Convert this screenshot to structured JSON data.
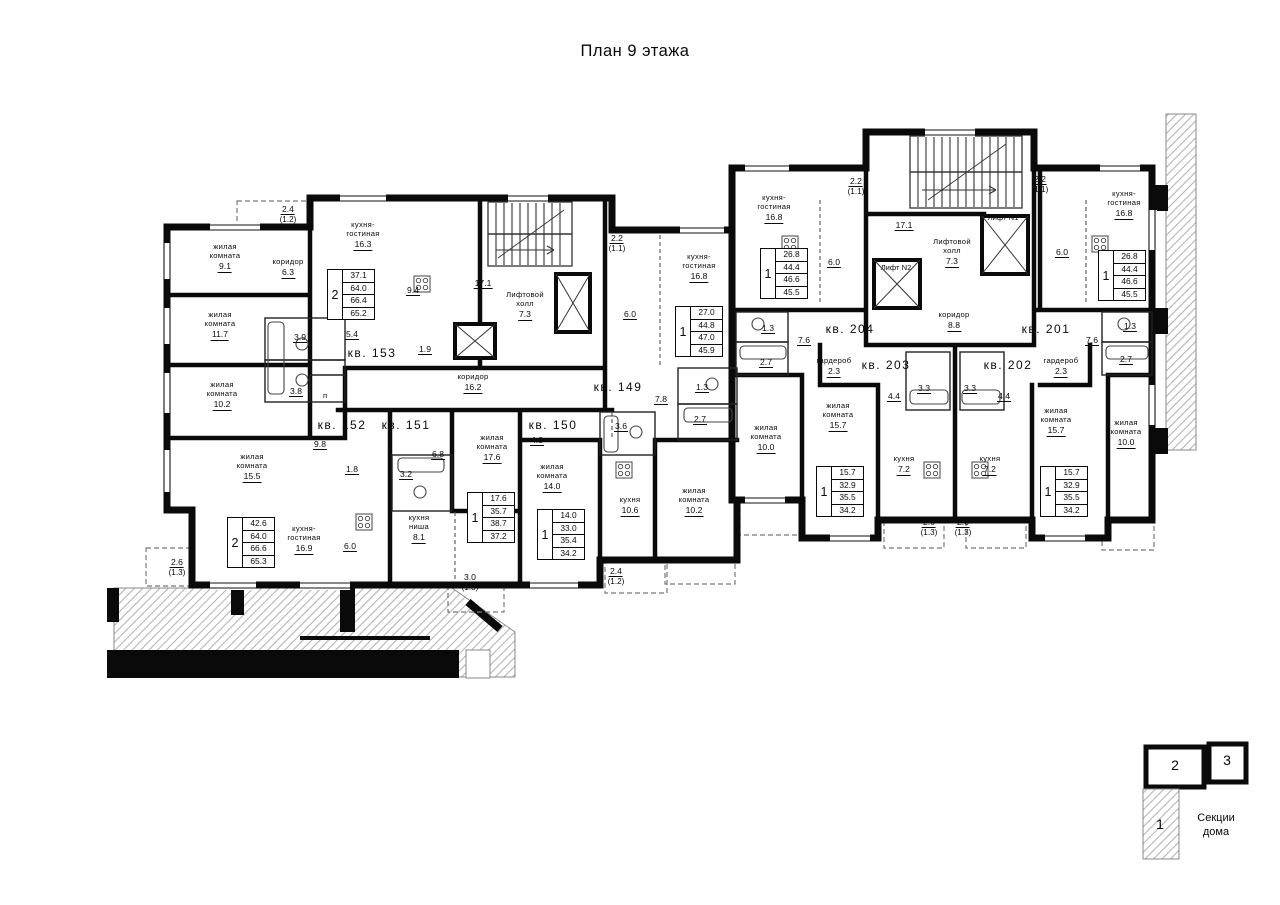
{
  "title": {
    "text": "План 9 этажа"
  },
  "colors": {
    "ink": "#0a0a0a",
    "hatch": "#b5b5b5",
    "balcony_dash": "#777777"
  },
  "legend": {
    "caption_lines": [
      "Секции",
      "дома"
    ],
    "sections": [
      "1",
      "2",
      "3"
    ]
  },
  "spec_tables": [
    {
      "x": 327,
      "y": 269,
      "rooms": "2",
      "values": [
        "37.1",
        "64.0",
        "66.4",
        "65.2"
      ]
    },
    {
      "x": 227,
      "y": 517,
      "rooms": "2",
      "values": [
        "42.6",
        "64.0",
        "66.6",
        "65.3"
      ]
    },
    {
      "x": 467,
      "y": 492,
      "rooms": "1",
      "values": [
        "17.6",
        "35.7",
        "38.7",
        "37.2"
      ]
    },
    {
      "x": 537,
      "y": 509,
      "rooms": "1",
      "values": [
        "14.0",
        "33.0",
        "35.4",
        "34.2"
      ]
    },
    {
      "x": 675,
      "y": 306,
      "rooms": "1",
      "values": [
        "27.0",
        "44.8",
        "47.0",
        "45.9"
      ]
    },
    {
      "x": 760,
      "y": 248,
      "rooms": "1",
      "values": [
        "26.8",
        "44.4",
        "46.6",
        "45.5"
      ]
    },
    {
      "x": 816,
      "y": 466,
      "rooms": "1",
      "values": [
        "15.7",
        "32.9",
        "35.5",
        "34.2"
      ]
    },
    {
      "x": 1040,
      "y": 466,
      "rooms": "1",
      "values": [
        "15.7",
        "32.9",
        "35.5",
        "34.2"
      ]
    },
    {
      "x": 1098,
      "y": 250,
      "rooms": "1",
      "values": [
        "26.8",
        "44.4",
        "46.6",
        "45.5"
      ]
    }
  ],
  "labels": [
    {
      "x": 225,
      "y": 243,
      "kind": "room",
      "lines": [
        "жилая",
        "комната"
      ],
      "area": "9.1"
    },
    {
      "x": 288,
      "y": 258,
      "kind": "room",
      "lines": [
        "коридор"
      ],
      "area": "6.3"
    },
    {
      "x": 363,
      "y": 221,
      "kind": "room",
      "lines": [
        "кухня-",
        "гостиная"
      ],
      "area": "16.3"
    },
    {
      "x": 413,
      "y": 284,
      "kind": "num",
      "area": "9.4"
    },
    {
      "x": 220,
      "y": 311,
      "kind": "room",
      "lines": [
        "жилая",
        "комната"
      ],
      "area": "11.7"
    },
    {
      "x": 300,
      "y": 331,
      "kind": "num",
      "area": "3.9"
    },
    {
      "x": 352,
      "y": 328,
      "kind": "num",
      "area": "5.4"
    },
    {
      "x": 425,
      "y": 343,
      "kind": "num",
      "area": "1.9"
    },
    {
      "x": 222,
      "y": 381,
      "kind": "room",
      "lines": [
        "жилая",
        "комната"
      ],
      "area": "10.2"
    },
    {
      "x": 296,
      "y": 385,
      "kind": "num",
      "area": "3.8"
    },
    {
      "x": 325,
      "y": 392,
      "kind": "lift",
      "lines": [
        "п"
      ]
    },
    {
      "x": 288,
      "y": 203,
      "kind": "num",
      "area": "2.4",
      "sub": "(1.2)"
    },
    {
      "x": 372,
      "y": 346,
      "kind": "apt",
      "lines": [
        "кв. 153"
      ]
    },
    {
      "x": 483,
      "y": 277,
      "kind": "num",
      "area": "17.1"
    },
    {
      "x": 525,
      "y": 291,
      "kind": "room",
      "lines": [
        "Лифтовой",
        "холл"
      ],
      "area": "7.3"
    },
    {
      "x": 473,
      "y": 373,
      "kind": "room",
      "lines": [
        "коридор"
      ],
      "area": "16.2"
    },
    {
      "x": 342,
      "y": 418,
      "kind": "apt",
      "lines": [
        "кв. 152"
      ]
    },
    {
      "x": 320,
      "y": 438,
      "kind": "num",
      "area": "9.8"
    },
    {
      "x": 252,
      "y": 453,
      "kind": "room",
      "lines": [
        "жилая",
        "комната"
      ],
      "area": "15.5"
    },
    {
      "x": 352,
      "y": 463,
      "kind": "num",
      "area": "1.8"
    },
    {
      "x": 304,
      "y": 525,
      "kind": "room",
      "lines": [
        "кухня-",
        "гостиная"
      ],
      "area": "16.9"
    },
    {
      "x": 350,
      "y": 540,
      "kind": "num",
      "area": "6.0"
    },
    {
      "x": 177,
      "y": 556,
      "kind": "num",
      "area": "2.6",
      "sub": "(1.3)"
    },
    {
      "x": 406,
      "y": 418,
      "kind": "apt",
      "lines": [
        "кв. 151"
      ]
    },
    {
      "x": 406,
      "y": 468,
      "kind": "num",
      "area": "3.2"
    },
    {
      "x": 438,
      "y": 448,
      "kind": "num",
      "area": "6.8"
    },
    {
      "x": 492,
      "y": 434,
      "kind": "room",
      "lines": [
        "жилая",
        "комната"
      ],
      "area": "17.6"
    },
    {
      "x": 419,
      "y": 514,
      "kind": "room",
      "lines": [
        "кухня",
        "ниша"
      ],
      "area": "8.1"
    },
    {
      "x": 470,
      "y": 571,
      "kind": "num",
      "area": "3.0",
      "sub": "(1.5)"
    },
    {
      "x": 553,
      "y": 418,
      "kind": "apt",
      "lines": [
        "кв. 150"
      ]
    },
    {
      "x": 537,
      "y": 434,
      "kind": "num",
      "area": "4.8"
    },
    {
      "x": 621,
      "y": 420,
      "kind": "num",
      "area": "3.6"
    },
    {
      "x": 552,
      "y": 463,
      "kind": "room",
      "lines": [
        "жилая",
        "комната"
      ],
      "area": "14.0"
    },
    {
      "x": 630,
      "y": 496,
      "kind": "room",
      "lines": [
        "кухня"
      ],
      "area": "10.6"
    },
    {
      "x": 616,
      "y": 565,
      "kind": "num",
      "area": "2.4",
      "sub": "(1.2)"
    },
    {
      "x": 618,
      "y": 380,
      "kind": "apt",
      "lines": [
        "кв. 149"
      ]
    },
    {
      "x": 661,
      "y": 393,
      "kind": "num",
      "area": "7.8"
    },
    {
      "x": 699,
      "y": 253,
      "kind": "room",
      "lines": [
        "кухня-",
        "гостиная"
      ],
      "area": "16.8"
    },
    {
      "x": 630,
      "y": 308,
      "kind": "num",
      "area": "6.0"
    },
    {
      "x": 617,
      "y": 232,
      "kind": "num",
      "area": "2.2",
      "sub": "(1.1)"
    },
    {
      "x": 702,
      "y": 381,
      "kind": "num",
      "area": "1.3"
    },
    {
      "x": 700,
      "y": 413,
      "kind": "num",
      "area": "2.7"
    },
    {
      "x": 694,
      "y": 487,
      "kind": "room",
      "lines": [
        "жилая",
        "комната"
      ],
      "area": "10.2"
    },
    {
      "x": 774,
      "y": 194,
      "kind": "room",
      "lines": [
        "кухня-",
        "гостиная"
      ],
      "area": "16.8"
    },
    {
      "x": 856,
      "y": 175,
      "kind": "num",
      "area": "2.2",
      "sub": "(1.1)"
    },
    {
      "x": 904,
      "y": 219,
      "kind": "num",
      "area": "17.1"
    },
    {
      "x": 1003,
      "y": 214,
      "kind": "lift",
      "lines": [
        "Лифт N1"
      ]
    },
    {
      "x": 896,
      "y": 264,
      "kind": "lift",
      "lines": [
        "Лифт N2"
      ]
    },
    {
      "x": 952,
      "y": 238,
      "kind": "room",
      "lines": [
        "Лифтовой",
        "холл"
      ],
      "area": "7.3"
    },
    {
      "x": 834,
      "y": 256,
      "kind": "num",
      "area": "6.0"
    },
    {
      "x": 850,
      "y": 322,
      "kind": "apt",
      "lines": [
        "кв. 204"
      ]
    },
    {
      "x": 954,
      "y": 311,
      "kind": "room",
      "lines": [
        "коридор"
      ],
      "area": "8.8"
    },
    {
      "x": 768,
      "y": 322,
      "kind": "num",
      "area": "1.3"
    },
    {
      "x": 804,
      "y": 334,
      "kind": "num",
      "area": "7.6"
    },
    {
      "x": 766,
      "y": 356,
      "kind": "num",
      "area": "2.7"
    },
    {
      "x": 766,
      "y": 424,
      "kind": "room",
      "lines": [
        "жилая",
        "комната"
      ],
      "area": "10.0"
    },
    {
      "x": 834,
      "y": 357,
      "kind": "room",
      "lines": [
        "гардероб"
      ],
      "area": "2.3"
    },
    {
      "x": 838,
      "y": 402,
      "kind": "room",
      "lines": [
        "жилая",
        "комната"
      ],
      "area": "15.7"
    },
    {
      "x": 886,
      "y": 358,
      "kind": "apt",
      "lines": [
        "кв. 203"
      ]
    },
    {
      "x": 894,
      "y": 390,
      "kind": "num",
      "area": "4.4"
    },
    {
      "x": 924,
      "y": 382,
      "kind": "num",
      "area": "3.3"
    },
    {
      "x": 970,
      "y": 382,
      "kind": "num",
      "area": "3.3"
    },
    {
      "x": 1004,
      "y": 390,
      "kind": "num",
      "area": "4.4"
    },
    {
      "x": 904,
      "y": 455,
      "kind": "room",
      "lines": [
        "кухня"
      ],
      "area": "7.2"
    },
    {
      "x": 990,
      "y": 455,
      "kind": "room",
      "lines": [
        "кухня"
      ],
      "area": "7.2"
    },
    {
      "x": 929,
      "y": 516,
      "kind": "num",
      "area": "2.6",
      "sub": "(1.3)"
    },
    {
      "x": 963,
      "y": 516,
      "kind": "num",
      "area": "2.6",
      "sub": "(1.3)"
    },
    {
      "x": 1008,
      "y": 358,
      "kind": "apt",
      "lines": [
        "кв. 202"
      ]
    },
    {
      "x": 1061,
      "y": 357,
      "kind": "room",
      "lines": [
        "гардероб"
      ],
      "area": "2.3"
    },
    {
      "x": 1056,
      "y": 407,
      "kind": "room",
      "lines": [
        "жилая",
        "комната"
      ],
      "area": "15.7"
    },
    {
      "x": 1046,
      "y": 322,
      "kind": "apt",
      "lines": [
        "кв. 201"
      ]
    },
    {
      "x": 1092,
      "y": 334,
      "kind": "num",
      "area": "7.6"
    },
    {
      "x": 1130,
      "y": 320,
      "kind": "num",
      "area": "1.3"
    },
    {
      "x": 1126,
      "y": 353,
      "kind": "num",
      "area": "2.7"
    },
    {
      "x": 1126,
      "y": 419,
      "kind": "room",
      "lines": [
        "жилая",
        "комната"
      ],
      "area": "10.0"
    },
    {
      "x": 1124,
      "y": 190,
      "kind": "room",
      "lines": [
        "кухня-",
        "гостиная"
      ],
      "area": "16.8"
    },
    {
      "x": 1062,
      "y": 246,
      "kind": "num",
      "area": "6.0"
    },
    {
      "x": 1040,
      "y": 173,
      "kind": "num",
      "area": "2.2",
      "sub": "(1.1)"
    },
    {
      "x": 1216,
      "y": 812,
      "kind": "legend",
      "lines": [
        "Секции",
        "дома"
      ]
    },
    {
      "x": 1175,
      "y": 757,
      "kind": "section",
      "lines": [
        "2"
      ]
    },
    {
      "x": 1227,
      "y": 752,
      "kind": "section",
      "lines": [
        "3"
      ]
    },
    {
      "x": 1160,
      "y": 816,
      "kind": "section",
      "lines": [
        "1"
      ]
    }
  ]
}
